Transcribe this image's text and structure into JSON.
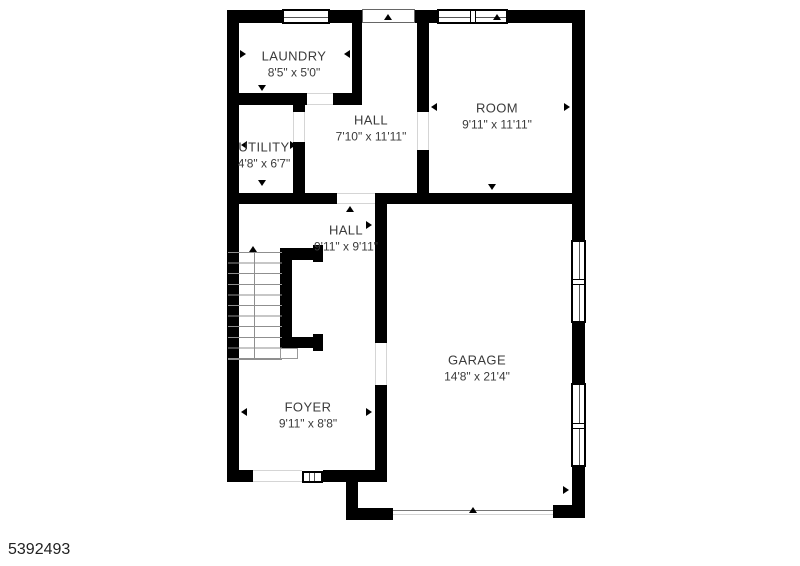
{
  "plan": {
    "type": "floor-plan",
    "wall_color": "#000000",
    "text_color": "#3b3b3b",
    "background": "#ffffff"
  },
  "rooms": [
    {
      "id": "laundry",
      "name": "LAUNDRY",
      "dims": "8'5\" x 5'0\""
    },
    {
      "id": "hall-upper",
      "name": "HALL",
      "dims": "7'10\" x 11'11\""
    },
    {
      "id": "room",
      "name": "ROOM",
      "dims": "9'11\" x 11'11\""
    },
    {
      "id": "utility",
      "name": "UTILITY",
      "dims": "4'8\" x 6'7\""
    },
    {
      "id": "hall-lower",
      "name": "HALL",
      "dims": "9'11\" x 9'11\""
    },
    {
      "id": "garage",
      "name": "GARAGE",
      "dims": "14'8\" x 21'4\""
    },
    {
      "id": "foyer",
      "name": "FOYER",
      "dims": "9'11\" x 8'8\""
    }
  ],
  "listing_id": "5392493"
}
